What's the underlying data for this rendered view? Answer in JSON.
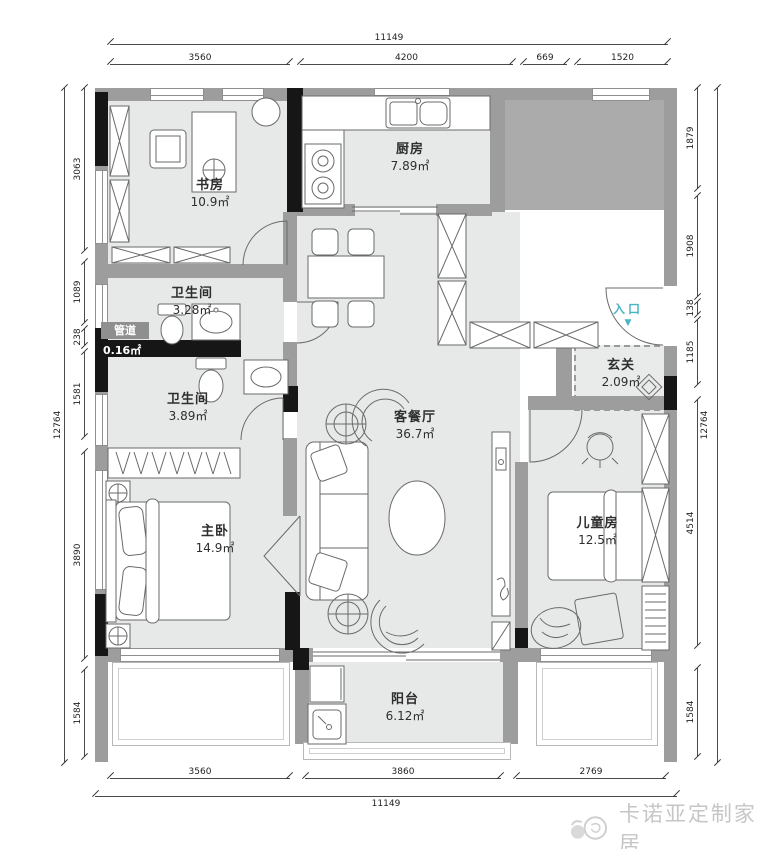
{
  "rooms": {
    "study": {
      "name": "书房",
      "area": "10.9㎡"
    },
    "kitchen": {
      "name": "厨房",
      "area": "7.89㎡"
    },
    "bath1": {
      "name": "卫生间",
      "area": "3.28㎡"
    },
    "duct": {
      "name": "管道",
      "area": "0.16㎡"
    },
    "bath2": {
      "name": "卫生间",
      "area": "3.89㎡"
    },
    "master": {
      "name": "主卧",
      "area": "14.9㎡"
    },
    "living": {
      "name": "客餐厅",
      "area": "36.7㎡"
    },
    "foyer": {
      "name": "玄关",
      "area": "2.09㎡"
    },
    "kids": {
      "name": "儿童房",
      "area": "12.5㎡"
    },
    "balcony": {
      "name": "阳台",
      "area": "6.12㎡"
    }
  },
  "entrance": {
    "label": "入口",
    "arrow": "▼"
  },
  "dims": {
    "top_total": "11149",
    "top": [
      "3560",
      "4200",
      "669",
      "1520"
    ],
    "bottom": [
      "3560",
      "3860",
      "2769"
    ],
    "bottom_total": "11149",
    "left_total": "12764",
    "left": [
      "3063",
      "1089",
      "238",
      "1581",
      "3890",
      "1584"
    ],
    "right": [
      "1879",
      "1908",
      "138",
      "1185",
      "4514",
      "1584"
    ],
    "right_total": "12764"
  },
  "watermark": {
    "text": "卡诺亚定制家居"
  },
  "colors": {
    "wall_gray": "#9d9d9d",
    "floor_gray": "#e7e9e8",
    "structure_black": "#161616",
    "entrance_teal": "#49b4c5",
    "watermark_gray": "#c6c6c6"
  }
}
